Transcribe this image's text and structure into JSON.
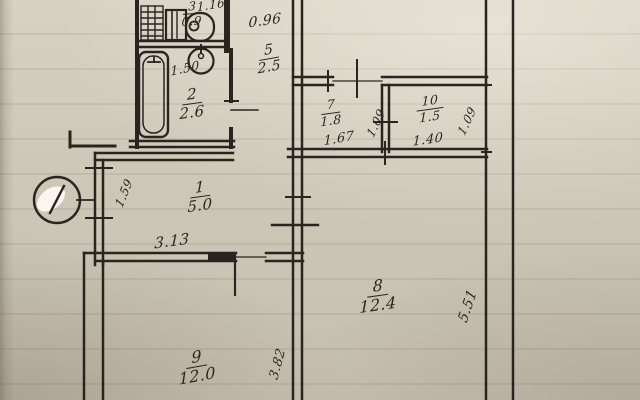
{
  "plan": {
    "ink_color": "#2a2420",
    "paper_color": "#cfc9ba",
    "rooms": {
      "room1": {
        "number": "1",
        "area": "5.0"
      },
      "room2": {
        "number": "2",
        "area": "2.6"
      },
      "room3": {
        "number": "3",
        "area": "0.9"
      },
      "room5": {
        "number": "5",
        "area": "2.5"
      },
      "room7": {
        "number": "7",
        "area": "1.8"
      },
      "room8": {
        "number": "8",
        "area": "12.4"
      },
      "room9": {
        "number": "9",
        "area": "12.0"
      },
      "room10": {
        "number": "10",
        "area": "1.5"
      }
    },
    "dimensions": {
      "wc_width": "1.16",
      "wc_leader": "0.96",
      "bath_length": "1.50",
      "room7_width": "1.67",
      "room7_depth": "1.09",
      "room10_width": "1.40",
      "room10_depth": "1.09",
      "room1_width": "3.13",
      "room1_entry": "1.59",
      "room8_depth": "5.51",
      "room9_depth": "3.82"
    },
    "fixtures": [
      "vent-grid",
      "toilet",
      "bathtub",
      "sink",
      "entry-circle-mark"
    ]
  }
}
